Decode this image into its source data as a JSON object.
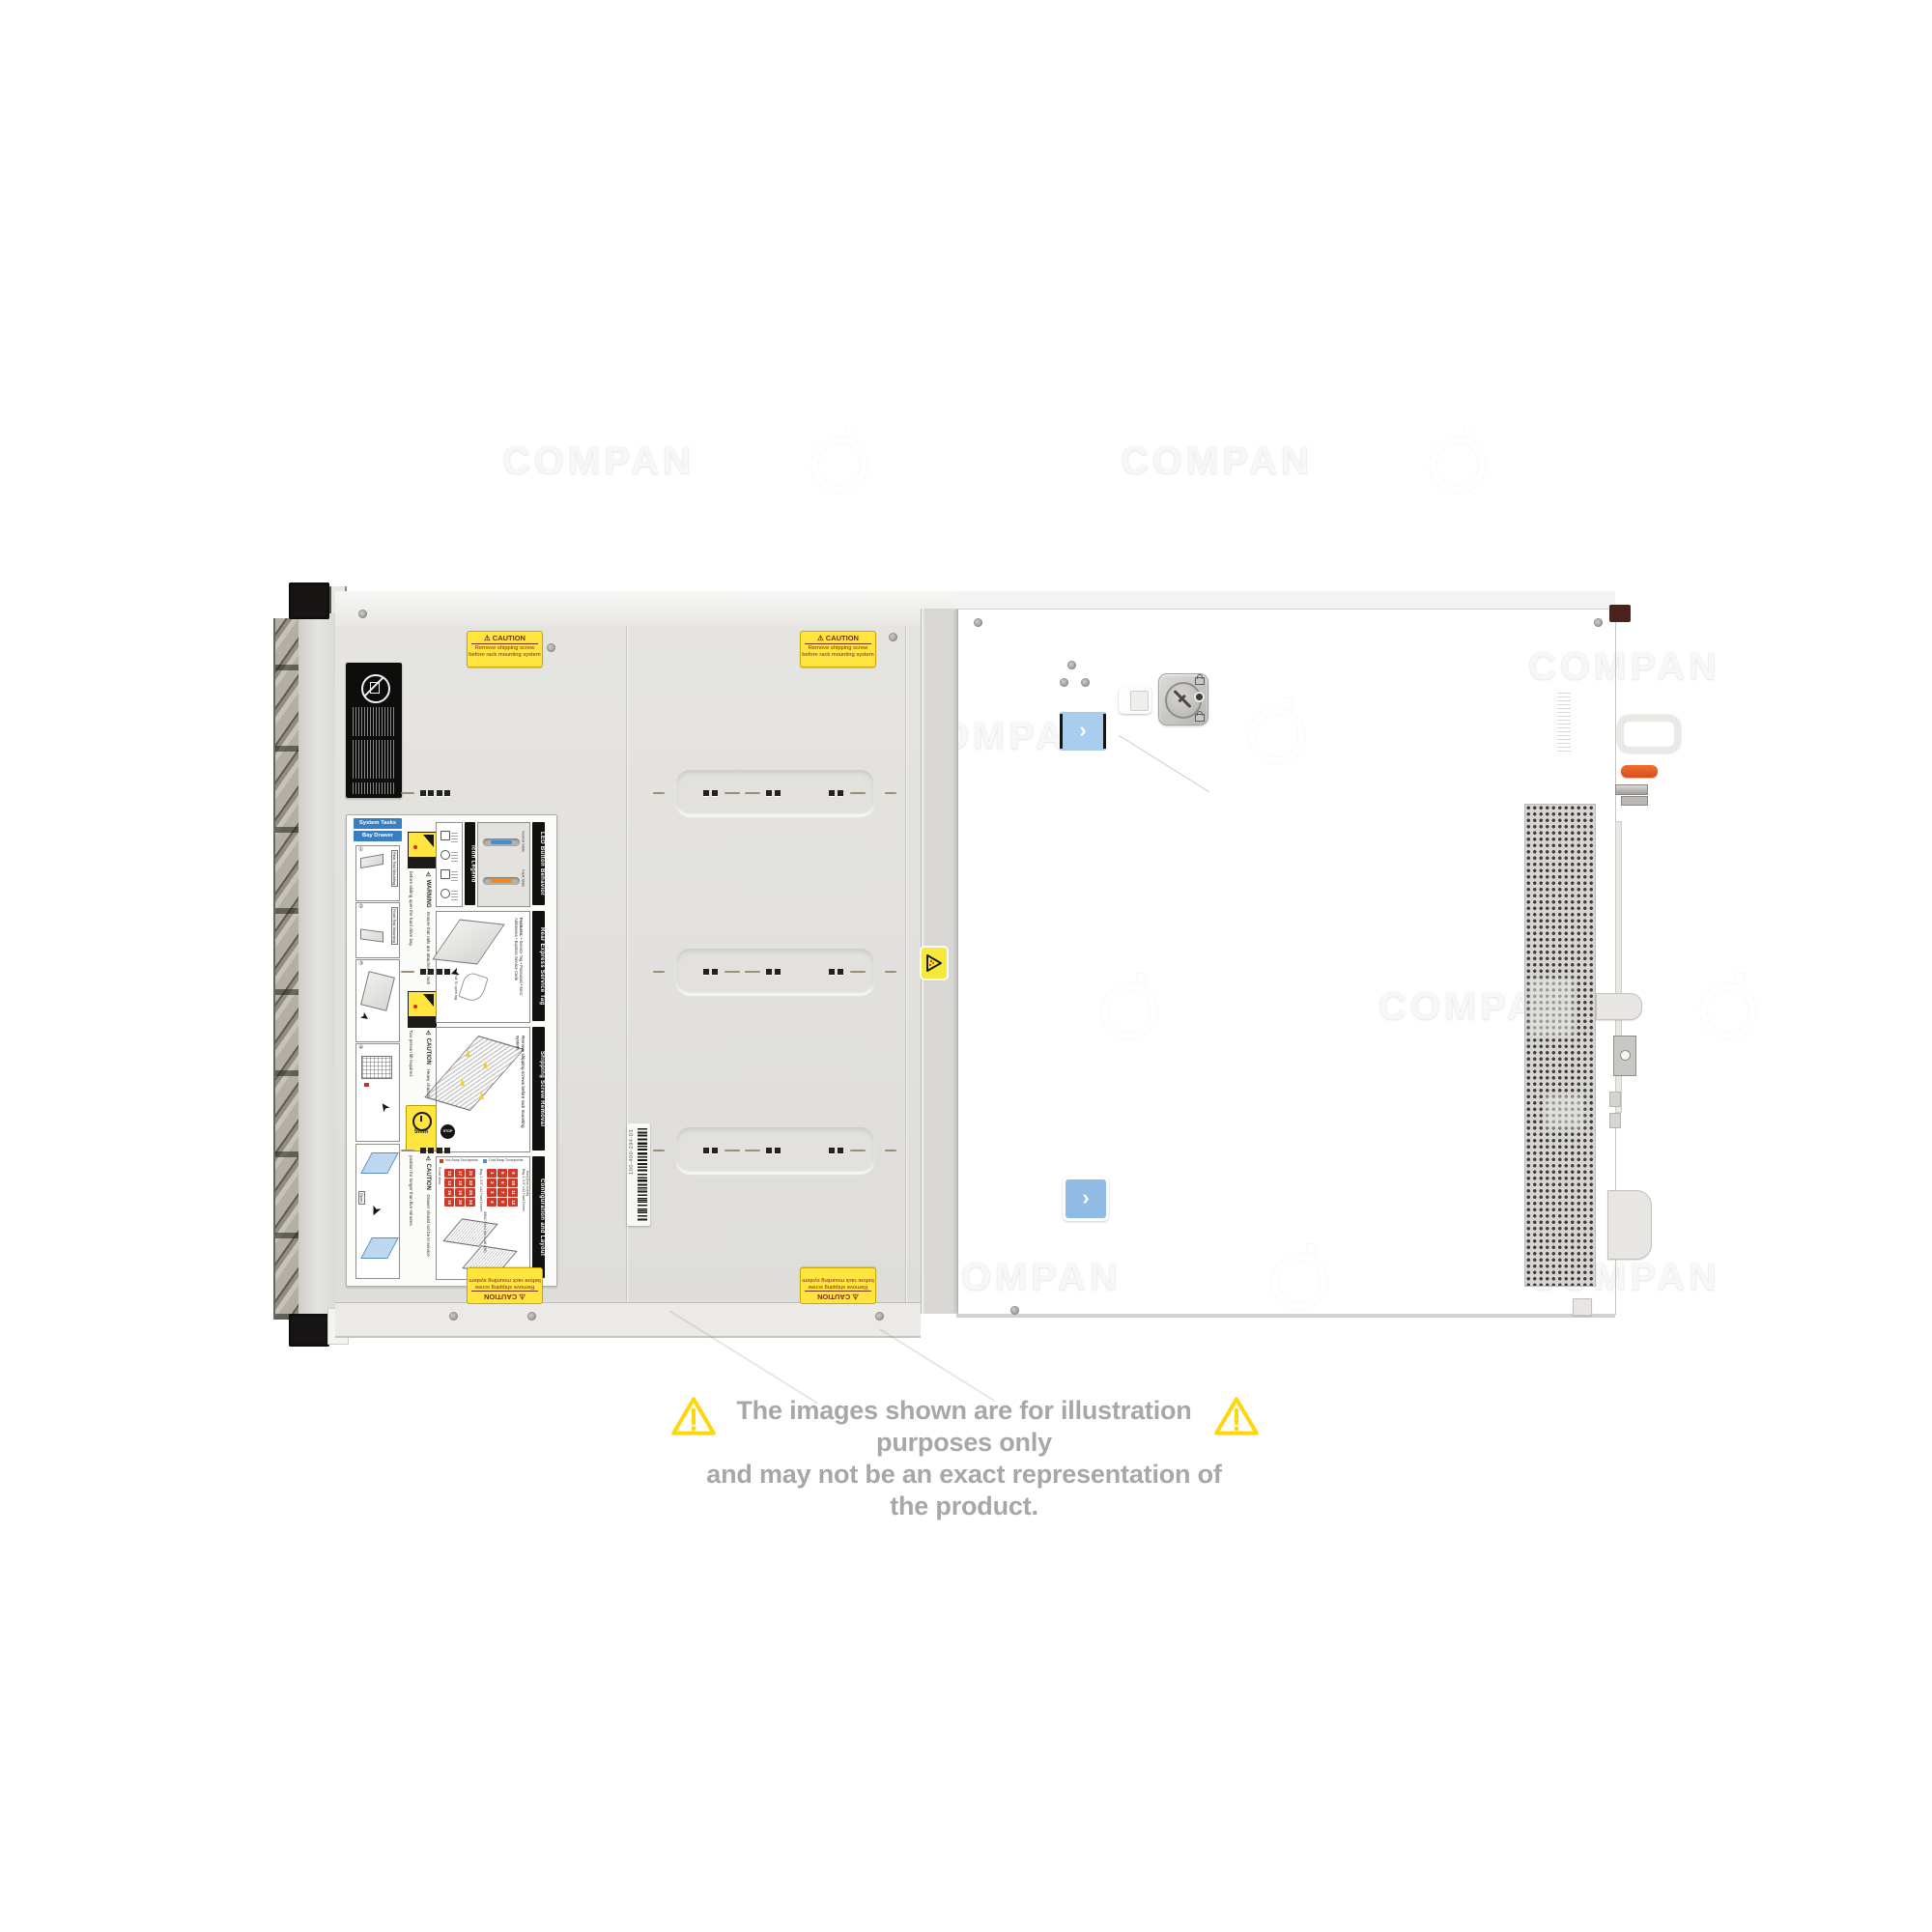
{
  "watermark": {
    "text": "COMPAN"
  },
  "disclaimer": {
    "line1": "The images shown are for illustration purposes only",
    "line2": "and may not be an exact representation of the product.",
    "text_color": "#a7a7a7",
    "triangle_color": "#ffd60a"
  },
  "colors": {
    "caution_yellow": "#ffe53d",
    "alert_red": "#cf3b2a",
    "led_blue": "#3f8fd6",
    "led_fault_orange": "#ee8a1e",
    "sticker_blue": "#a9cdec",
    "lever_orange": "#e05a1e"
  },
  "server": {
    "caution_sticker": {
      "title": "⚠ CAUTION",
      "line1": "Remove shipping screw",
      "line2": "before rack mounting system"
    },
    "barcode_label": {
      "text": "100-400-294-03"
    },
    "instruction_label": {
      "col_a": {
        "bar1": "System Tasks",
        "bar2": "Bay Drawer Operation",
        "rail1": "Rear Rail Mounting",
        "rail2": "Front Rail Mounting",
        "open_tag": "Open",
        "steps": [
          "①",
          "②",
          "③",
          "④"
        ]
      },
      "warnings": {
        "warning_title": "⚠ WARNING",
        "warning_body": "Ensure that rails are attached to rack before sliding open the hard drive bay.",
        "caution1_title": "⚠ CAUTION",
        "caution1_body": "Heavy chassis. Two person lift required.",
        "five_min": "5min",
        "caution2_title": "⚠ CAUTION",
        "caution2_body": "Drawer should not be in service position for longer than five minutes."
      },
      "icon_legend": {
        "title": "Icon Legend"
      },
      "led": {
        "title": "LED Button Behavior",
        "normal": "Normal State",
        "fault": "Fault State"
      },
      "service_tag": {
        "title": "Rear Express Service Tag",
        "features_heading": "Features:",
        "features": [
          "Service Tag",
          "Password",
          "MAC Addresses",
          "Express Service Code"
        ],
        "pull_note": "Pull To open tag"
      },
      "shipping": {
        "title": "Shipping Screw Removal",
        "stop": "STOP",
        "body": "Remove shipping screws before rack mounting system."
      },
      "config": {
        "title": "Configuration and Layout",
        "front_view": "Front View",
        "bay1": "Bay 1: 3.5\" x12 Hard Drives",
        "bay2": "Bay 2: 3.5\" x12 Hard Drives",
        "bay1_numbers": [
          1,
          2,
          3,
          4,
          5,
          6,
          7,
          8,
          9,
          10,
          11,
          12
        ],
        "bay2_numbers": [
          13,
          14,
          15,
          16,
          17,
          18,
          19,
          20,
          21,
          22,
          23,
          24
        ],
        "legend_hot": "Hot Swap Touchpoints",
        "legend_cold": "Cold Swap Touchpoints",
        "sub1": "Hard Drive Activity",
        "sub2": "iDRAC Direct (Micro-AB USB)"
      }
    }
  }
}
